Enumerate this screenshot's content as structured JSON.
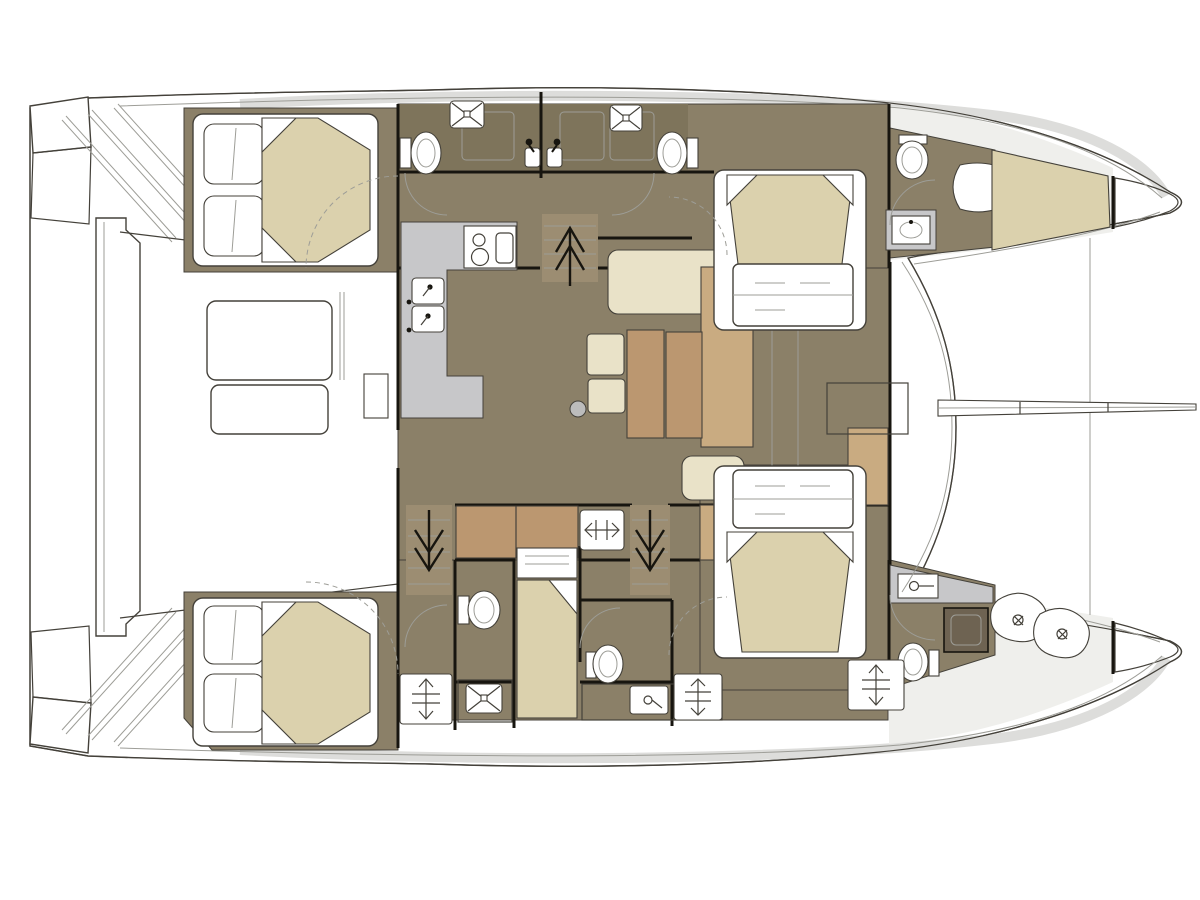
{
  "vessel": {
    "type": "catamaran yacht floor plan, top view",
    "orientation": "bow to the right, stern (transom steps and tender platform) to the left",
    "hulls": "port hull on top, starboard hull on bottom, bridgedeck saloon in the center"
  },
  "colors": {
    "white": "#ffffff",
    "outline": "#44413a",
    "wall": "#17150f",
    "line_light": "#9d9d97",
    "floor": "#8b8068",
    "cabinet": "#7e745b",
    "mattress": "#dbd1ad",
    "cream": "#e9e2c8",
    "tan": "#c9ab81",
    "wood": "#bb9770",
    "wood_dark": "#9c8d72",
    "counter": "#c7c7c9",
    "deck": "#dddddb",
    "deck_light": "#efefec",
    "shower_dark": "#6e6352",
    "metal": "#bcbcbc"
  },
  "regions": [
    "transom-steps-port",
    "transom-steps-starboard",
    "tender-platform",
    "aft-cockpit",
    "cockpit-table",
    "cockpit-bench",
    "saloon",
    "dinette-table",
    "settee",
    "ottoman",
    "l-sofa",
    "galley",
    "stove",
    "galley-double-sink",
    "galley-lower-cabinets",
    "companionway-stairs-up",
    "stairs-down-port",
    "stairs-down-starboard",
    "port-aft-cabin",
    "port-aft-head",
    "twin-washbasins",
    "port-fwd-head",
    "port-fwd-cabin",
    "port-bow-head",
    "port-bow-berth",
    "port-bow-locker",
    "stbd-aft-cabin",
    "stbd-aft-head",
    "skipper-berth",
    "stbd-mid-head",
    "stbd-fwd-cabin",
    "stbd-bow-head",
    "stbd-bow-stowage",
    "stbd-bow-locker",
    "foredeck",
    "foredeck-seat-box",
    "bowsprit",
    "deck-hatches"
  ],
  "icons": {
    "toilet": "oval bowl with cistern rectangle",
    "shower_tray": "rounded square with X diagonals and center drain",
    "washbasin": "small square basin with tap glyph",
    "stove": "two burner circles plus rounded rectangle",
    "stairs_arrow_up": "double chevron arrow pointing up",
    "stairs_arrow_down": "double chevron arrow pointing down",
    "deck_hatch": "white panel with double-headed arrow and tick bars",
    "double_bed": "beige trapezoid mattress, two white pillows, folded corners",
    "table_leg": "small gray circle"
  },
  "fixture_counts": {
    "double_beds": 4,
    "single_berths": 2,
    "toilets": 6,
    "shower_trays": 3,
    "dark_shower_cubicles": 1,
    "washbasins": 6,
    "staircases": 3,
    "deck_hatches": 4
  }
}
